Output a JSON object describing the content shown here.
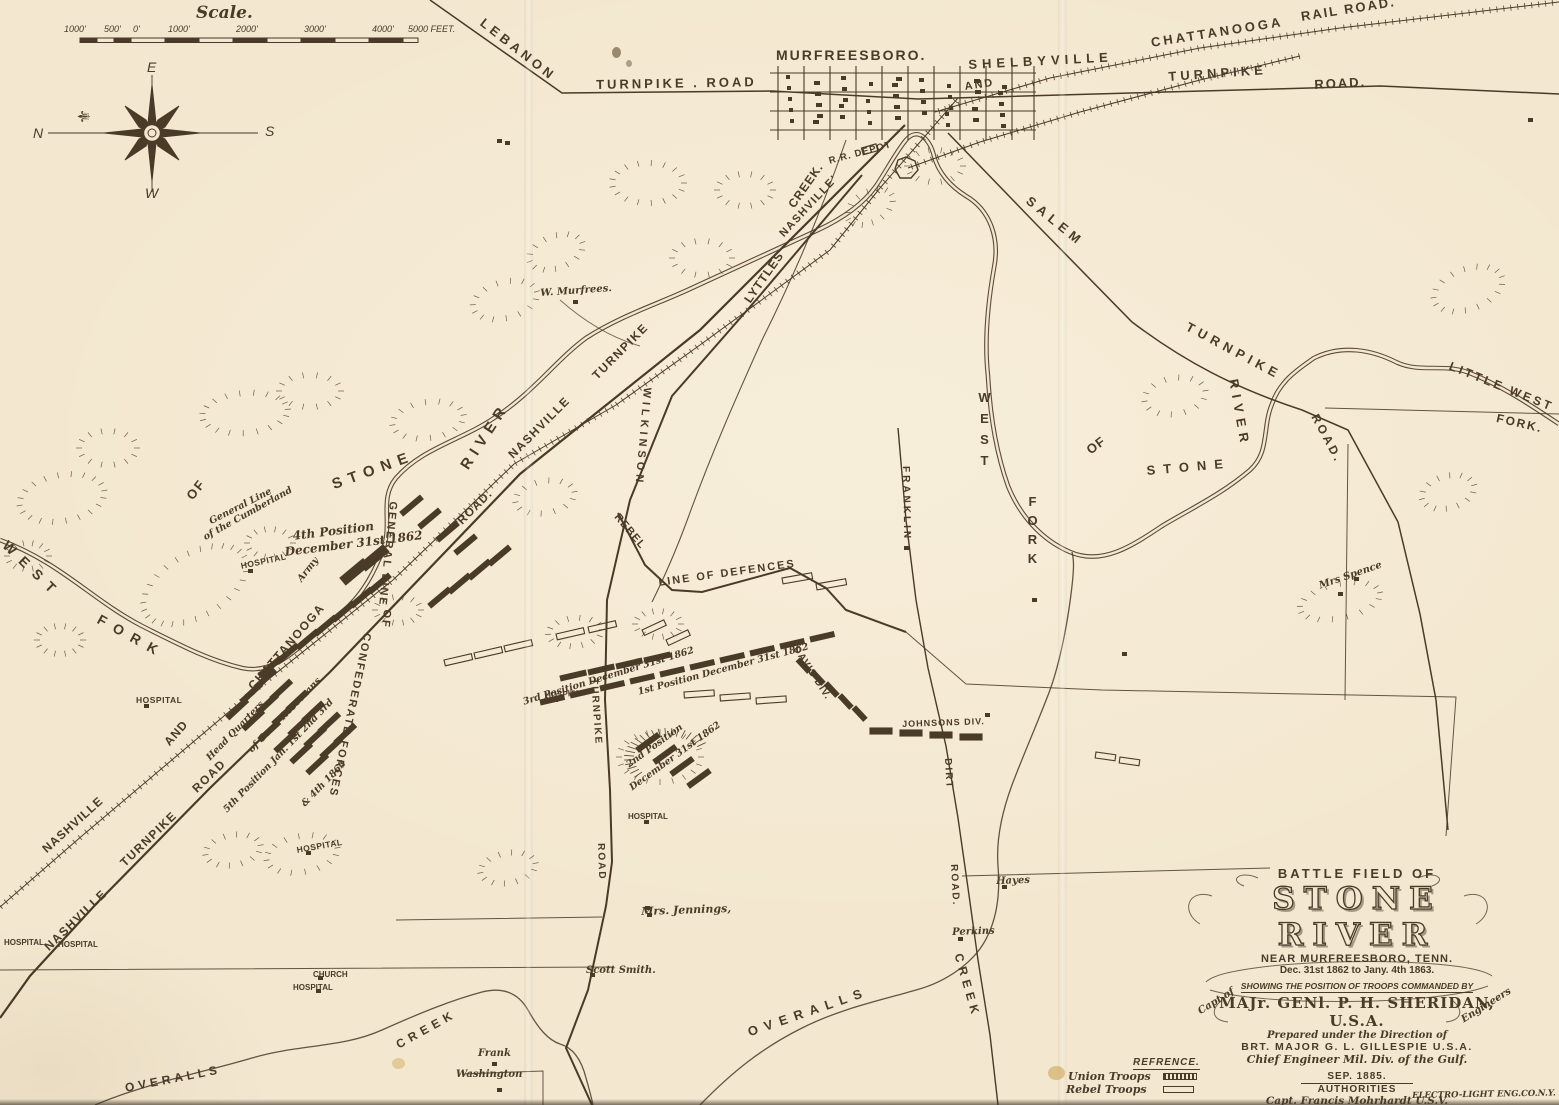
{
  "colors": {
    "paper": "#f3e7cf",
    "ink": "#4a3a28"
  },
  "scale_bar": {
    "title": "Scale.",
    "ticks": [
      "1000'",
      "500'",
      "0'",
      "1000'",
      "2000'",
      "3000'",
      "4000'",
      "5000 FEET."
    ]
  },
  "compass": {
    "n": "N",
    "e": "E",
    "s": "S",
    "w": "W"
  },
  "icons": {
    "fleur": "⚜"
  },
  "map_labels": [
    "LEBANON",
    "TURNPIKE . ROAD",
    "MURFREESBORO.",
    "SHELBYVILLE",
    "AND",
    "CHATTANOOGA",
    "RAIL ROAD.",
    "TURNPIKE",
    "ROAD.",
    "R.R. DEPOT",
    "NASHVILLE'",
    "CREEK.",
    "LYTTLES",
    "W. Murfrees.",
    "STONE",
    "RIVER",
    "ROAD.",
    "NASHVILLE",
    "TURNPIKE",
    "WILKINSON",
    "TURNPIKE",
    "ROAD",
    "REBEL",
    "LINE OF DEFENCES",
    "FRANKLIN",
    "4th Position",
    "December 31st 1862",
    "HOSPITAL",
    "General Line",
    "of the Cumberland",
    "Army",
    "GENERAL LINE",
    "OF",
    "CONFEDERATE FORCES",
    "CHATTANOOGA",
    "AND",
    "NASHVILLE",
    "HOSPITAL",
    "Head Quarters",
    "of Genl. Rosecrans",
    "5th Position Jan. 1st 2nd 3rd",
    "& 4th 1863",
    "ROAD",
    "TURNPIKE",
    "NASHVILLE",
    "HOSPITAL",
    "HOSPITAL",
    "HOSPITAL",
    "3rd Position December 31st 1862",
    "HOSPITAL",
    "1st Position December 31st 1862",
    "2nd Position",
    "December 31st 1862",
    "DAVIS DIV.",
    "JOHNSONS DIV.",
    "DIRT",
    "ROAD.",
    "Hayes",
    "Perkins",
    "Mrs. Jennings,",
    "Scott Smith.",
    "Frank",
    "Washington",
    "CHURCH",
    "HOSPITAL",
    "CREEK",
    "OVERALLS",
    "OVERALLS",
    "CREEK",
    "WEST",
    "FORK",
    "OF",
    "WEST",
    "FORK",
    "OF",
    "STONE",
    "RIVER",
    "SALEM",
    "TURNPIKE",
    "ROAD.",
    "LITTLE WEST",
    "FORK.",
    "Mrs Spence",
    "HOSPITAL"
  ],
  "legend": {
    "title": "REFRENCE.",
    "union": "Union Troops",
    "rebel": "Rebel Troops"
  },
  "title_block": {
    "line1": "BATTLE FIELD OF",
    "title": "STONE RIVER",
    "near": "NEAR MURFREESBORO, TENN.",
    "dates": "Dec. 31st 1862 to Jany. 4th 1863.",
    "showing": "SHOWING THE POSITION OF TROOPS COMMANDED BY",
    "commander": "MAJr. GENl. P. H. SHERIDAN, U.S.A.",
    "prepared": "Prepared under the Direction of",
    "capt_of": "Capt of",
    "major": "BRT. MAJOR  G. L. GILLESPIE  U.S.A.",
    "engineers": "Engineers",
    "chief": "Chief Engineer Mil. Div. of the Gulf.",
    "date": "SEP. 1885.",
    "authorities": "AUTHORITIES",
    "auth1": "Capt. Francis Mohrhardt U.S.V.",
    "auth2": "H.C. Koch Asst. C. Engt"
  },
  "credit": "ELECTRO-LIGHT ENG.CO.N.Y."
}
